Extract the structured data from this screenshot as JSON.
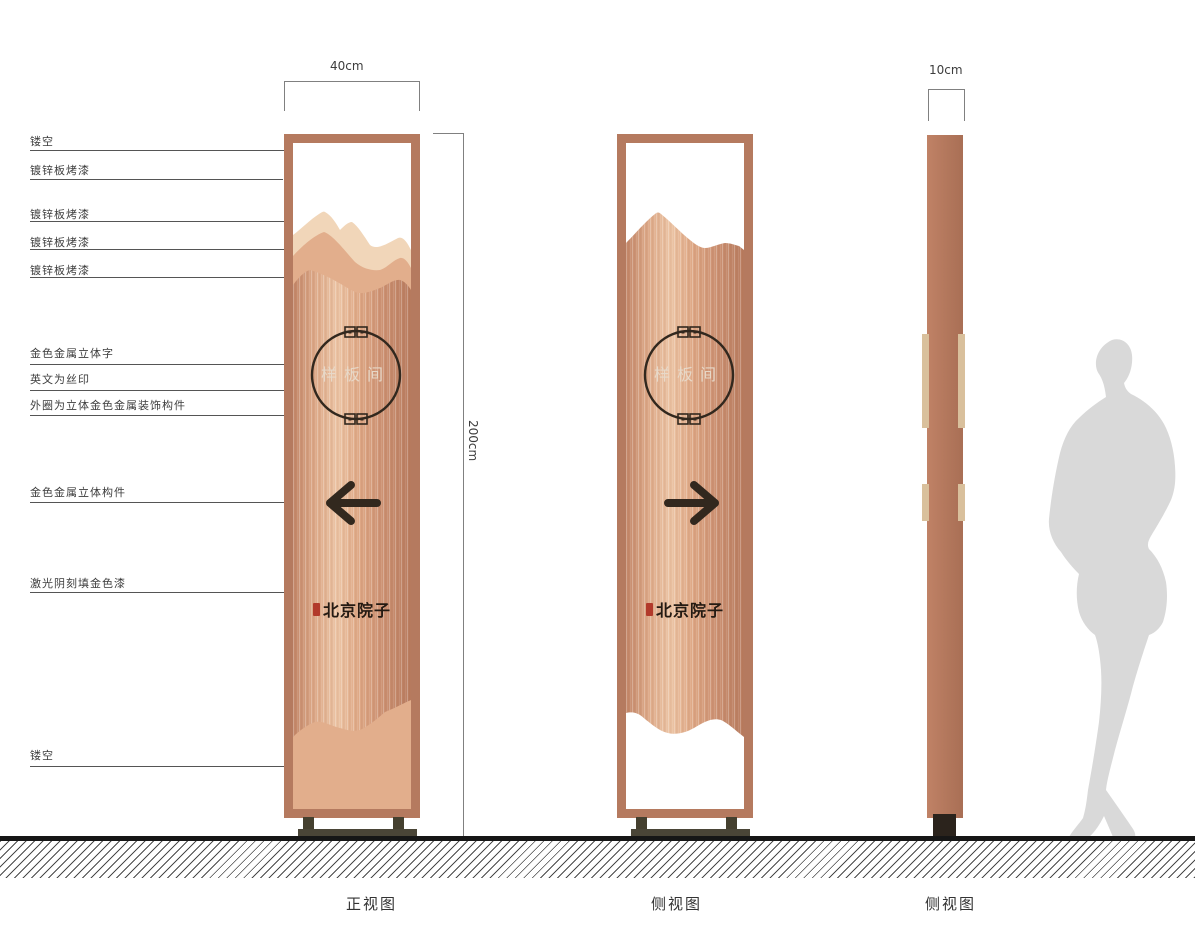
{
  "callouts": [
    "镂空",
    "镀锌板烤漆",
    "镀锌板烤漆",
    "镀锌板烤漆",
    "镀锌板烤漆",
    "金色金属立体字",
    "英文为丝印",
    "外圈为立体金色金属装饰构件",
    "金色金属立体构件",
    "激光阴刻填金色漆",
    "镂空"
  ],
  "dimensions": {
    "front_width": "40cm",
    "side_width": "10cm",
    "height": "200cm"
  },
  "sign": {
    "plaque": "样板间",
    "brand": "北京院子"
  },
  "views": {
    "front": "正视图",
    "side1": "侧视图",
    "side2": "侧视图"
  },
  "icons": {
    "front_arrow": "left-arrow",
    "side_arrow": "right-arrow",
    "seal": "seal-stamp",
    "circle_ornament": "fret-ornament",
    "figure": "human-silhouette"
  },
  "colors": {
    "frame": "#b57a5f",
    "panel_light": "#ecc4a4",
    "panel_dark": "#b87c5f",
    "mountain_light": "#f1d6b9",
    "mountain_mid": "#e2ae8c",
    "ink": "#32281e",
    "plaque_text": "#e8dccd",
    "seal_red": "#b23a2b",
    "base": "#4a4537",
    "ground": "#161616",
    "silhouette": "#d9d9d9",
    "label_text": "#3d3d3d"
  }
}
